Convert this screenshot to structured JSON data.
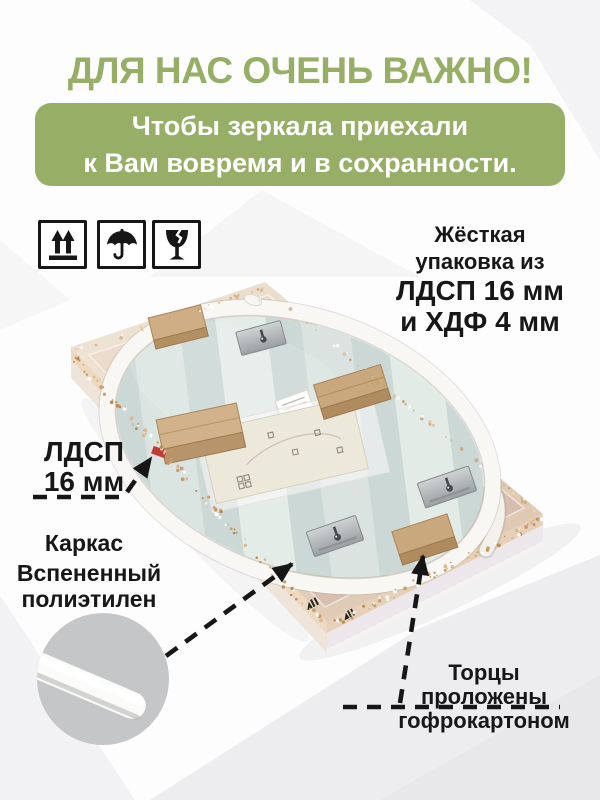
{
  "title": "ДЛЯ НАС ОЧЕНЬ ВАЖНО!",
  "banner": {
    "line1": "Чтобы зеркала приехали",
    "line2": "к Вам вовремя и в сохранности."
  },
  "handling_icons": [
    {
      "name": "this-side-up-icon"
    },
    {
      "name": "keep-dry-icon"
    },
    {
      "name": "fragile-icon"
    }
  ],
  "packaging_note": {
    "line1": "Жёсткая",
    "line2": "упаковка из",
    "line3": "ЛДСП 16 мм",
    "line4": "и ХДФ 4 мм"
  },
  "callouts": {
    "frame": {
      "line1": "ЛДСП",
      "line2": "16 мм",
      "caption": "Каркас"
    },
    "foam": {
      "line1": "Вспененный",
      "line2": "полиэтилен"
    },
    "edges": {
      "line1": "Торцы",
      "line2": "проложены",
      "line3": "гофрокартоном"
    }
  },
  "colors": {
    "accent_green": "#96ae66",
    "banner_text": "#ffffff",
    "label_text": "#171717",
    "foam_circle": "#c5c6c8"
  }
}
